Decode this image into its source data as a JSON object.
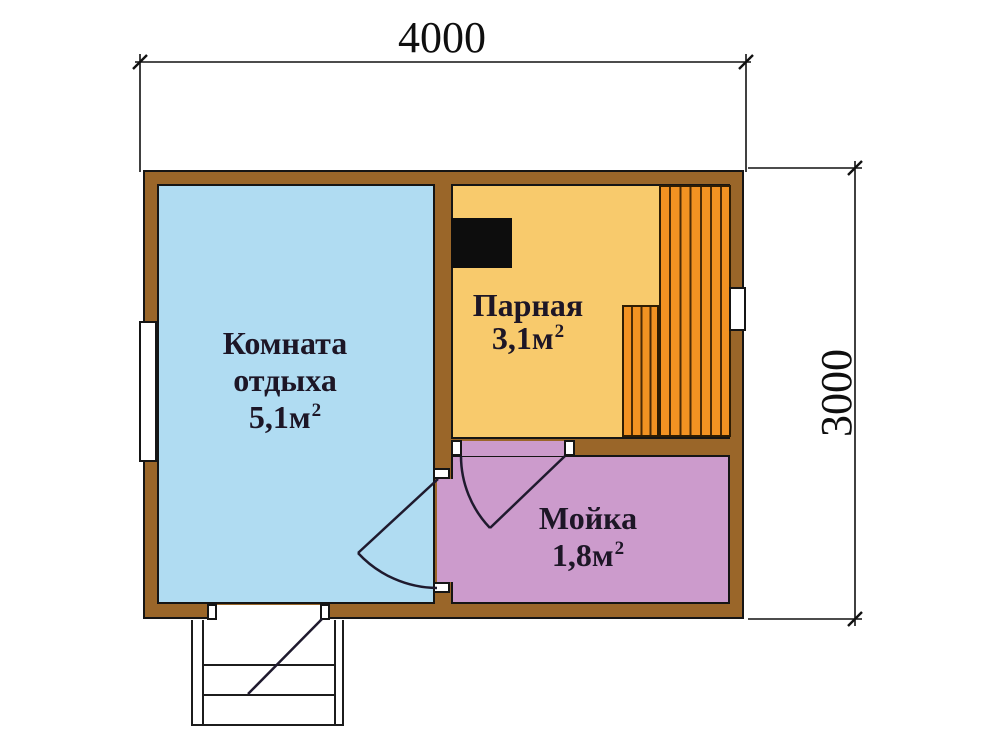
{
  "dimensions": {
    "width_mm": "4000",
    "height_mm": "3000"
  },
  "rooms": {
    "rest": {
      "line1": "Комната",
      "line2": "отдыха",
      "area": "5,1м",
      "area_sup": "2"
    },
    "parnaya": {
      "name": "Парная",
      "area": "3,1м",
      "area_sup": "2"
    },
    "moyka": {
      "name": "Мойка",
      "area": "1,8м",
      "area_sup": "2"
    }
  },
  "colors": {
    "wall_brown": "#9a6629",
    "rest_room_blue": "#b0dcf2",
    "steam_room_yellow": "#f8ca6c",
    "wash_room_pink": "#cc9bcc",
    "bench_orange": "#f29222",
    "bench_stripe": "#4a2a06",
    "stove_black": "#0d0d0d",
    "outline_black": "#151515",
    "label_text": "#1d1626"
  }
}
